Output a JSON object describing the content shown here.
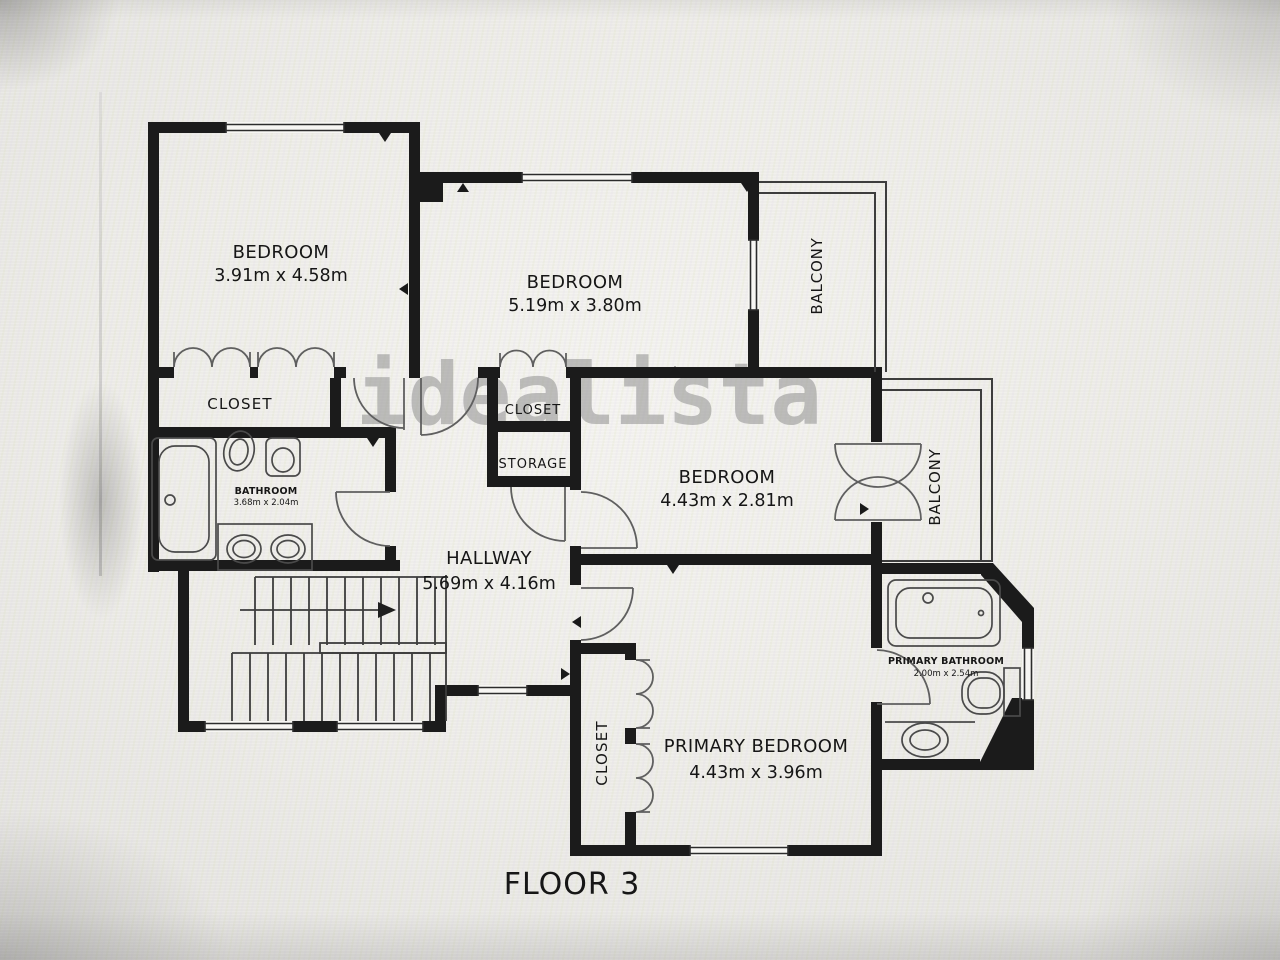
{
  "floor_label": "FLOOR 3",
  "watermark": "idealista",
  "colors": {
    "wall": "#1b1b1b",
    "thin_line": "#3d3d3d",
    "door_line": "#5f5f5f",
    "label_text": "#161616",
    "watermark_gray": "#8a8a8a",
    "background": "#eeede9"
  },
  "rooms": {
    "bedroom1": {
      "name": "BEDROOM",
      "dims": "3.91m x 4.58m"
    },
    "bedroom2": {
      "name": "BEDROOM",
      "dims": "5.19m x 3.80m"
    },
    "bedroom3": {
      "name": "BEDROOM",
      "dims": "4.43m x 2.81m"
    },
    "primary_bedroom": {
      "name": "PRIMARY BEDROOM",
      "dims": "4.43m x 3.96m"
    },
    "hallway": {
      "name": "HALLWAY",
      "dims": "5.69m x 4.16m"
    },
    "bathroom": {
      "name": "BATHROOM",
      "dims": "3.68m x 2.04m"
    },
    "primary_bathroom": {
      "name": "PRIMARY BATHROOM",
      "dims": "2.00m x 2.54m"
    },
    "closet_left": {
      "name": "CLOSET"
    },
    "closet_mid": {
      "name": "CLOSET"
    },
    "storage": {
      "name": "STORAGE"
    },
    "closet_primary": {
      "name": "CLOSET"
    },
    "balcony_top": {
      "name": "BALCONY"
    },
    "balcony_right": {
      "name": "BALCONY"
    }
  }
}
